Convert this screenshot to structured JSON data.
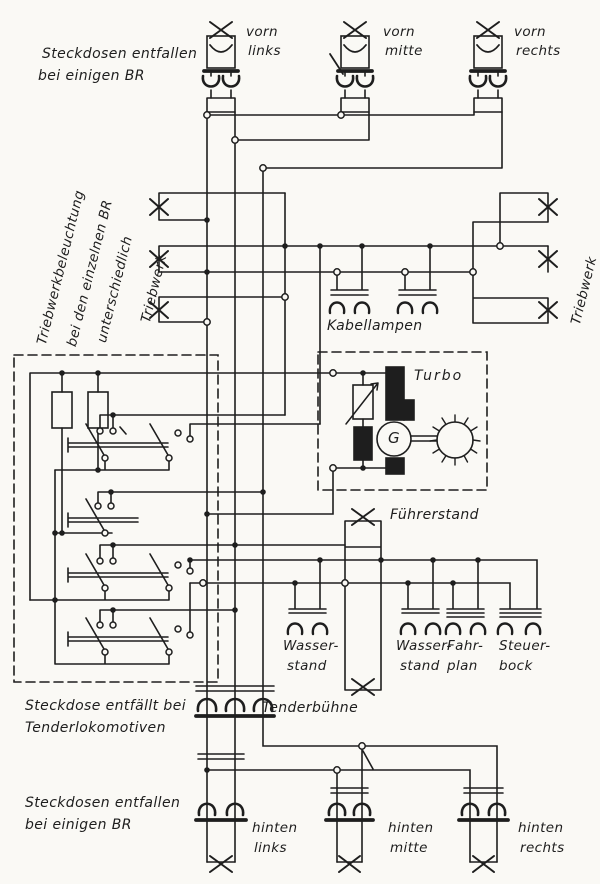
{
  "page": {
    "background": "#faf9f5",
    "ink": "#1e1e1e",
    "type": "hand-drawn wiring schematic"
  },
  "labels": {
    "note_top_left": [
      "Steckdosen entfallen",
      "bei einigen BR"
    ],
    "note_rotated": [
      "Triebwerkbeleuchtung",
      "bei den einzelnen BR",
      "unterschiedlich"
    ],
    "triebwerk_left": "Triebwerk",
    "triebwerk_right": "Triebwerk",
    "kabellampen": "Kabellampen",
    "turbo": "Turbo",
    "generator": "G",
    "fuehrerstand": "Führerstand",
    "wasserstand_1": [
      "Wasser-",
      "stand"
    ],
    "wasserstand_2": [
      "Wasser-",
      "stand"
    ],
    "fahrplan": [
      "Fahr-",
      "plan"
    ],
    "steuerbock": [
      "Steuer-",
      "bock"
    ],
    "tenderbuehne": "Tenderbühne",
    "note_tender": [
      "Steckdose entfällt bei",
      "Tenderlokomotiven"
    ],
    "note_bottom_left": [
      "Steckdosen entfallen",
      "bei einigen BR"
    ],
    "lamps": {
      "vorn_links": [
        "vorn",
        "links"
      ],
      "vorn_mitte": [
        "vorn",
        "mitte"
      ],
      "vorn_rechts": [
        "vorn",
        "rechts"
      ],
      "hinten_links": [
        "hinten",
        "links"
      ],
      "hinten_mitte": [
        "hinten",
        "mitte"
      ],
      "hinten_rechts": [
        "hinten",
        "rechts"
      ]
    }
  }
}
